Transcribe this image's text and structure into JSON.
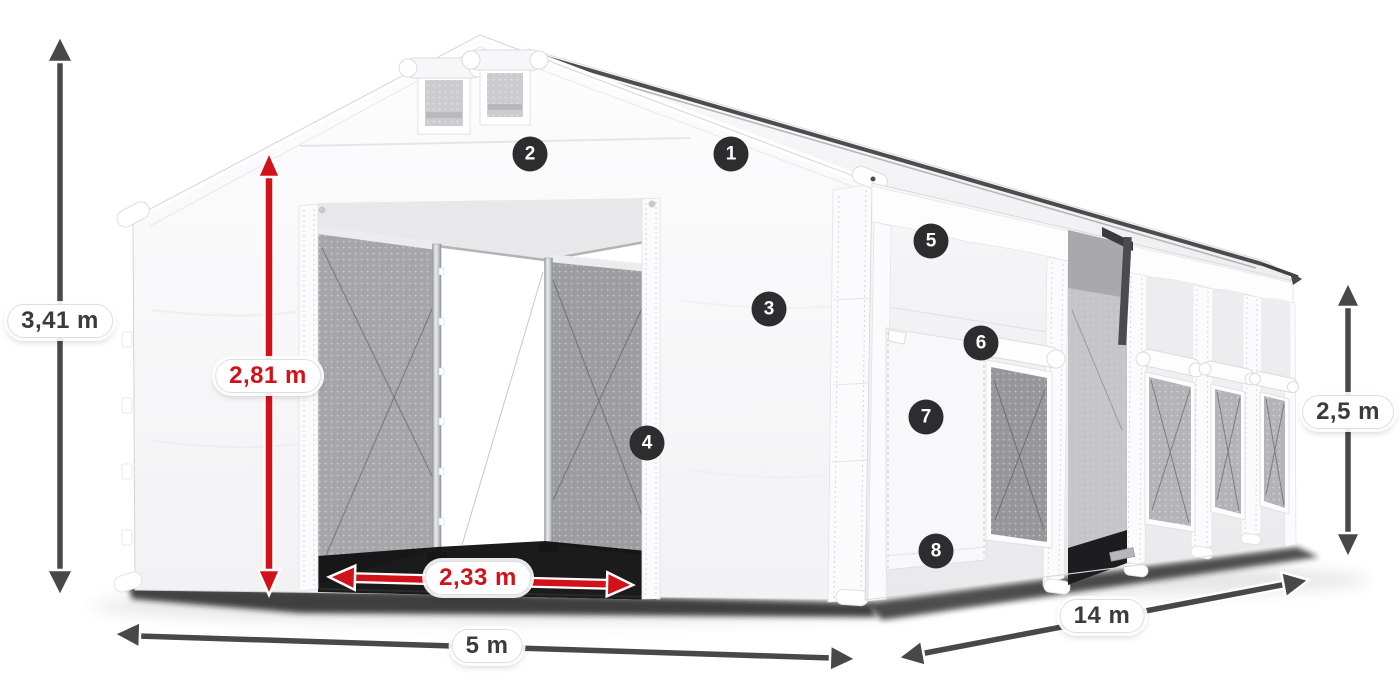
{
  "scene": {
    "description": "White storage tent shown in three-quarter view with dimension arrows and numbered part markers",
    "background_color": "#ffffff"
  },
  "colors": {
    "dimension_arrow_gray": "#48484b",
    "dimension_accent_red": "#d2121a",
    "badge_background": "#2d2d30",
    "badge_text": "#ffffff"
  },
  "dimensions": {
    "total_height": {
      "label": "3,41 m",
      "style": "gray"
    },
    "door_height": {
      "label": "2,81 m",
      "style": "red"
    },
    "door_width": {
      "label": "2,33 m",
      "style": "red"
    },
    "gable_width": {
      "label": "5 m",
      "style": "gray"
    },
    "side_length": {
      "label": "14 m",
      "style": "gray"
    },
    "side_height": {
      "label": "2,5 m",
      "style": "gray"
    }
  },
  "badges": [
    {
      "number": "1"
    },
    {
      "number": "2"
    },
    {
      "number": "3"
    },
    {
      "number": "4"
    },
    {
      "number": "5"
    },
    {
      "number": "6"
    },
    {
      "number": "7"
    },
    {
      "number": "8"
    }
  ]
}
